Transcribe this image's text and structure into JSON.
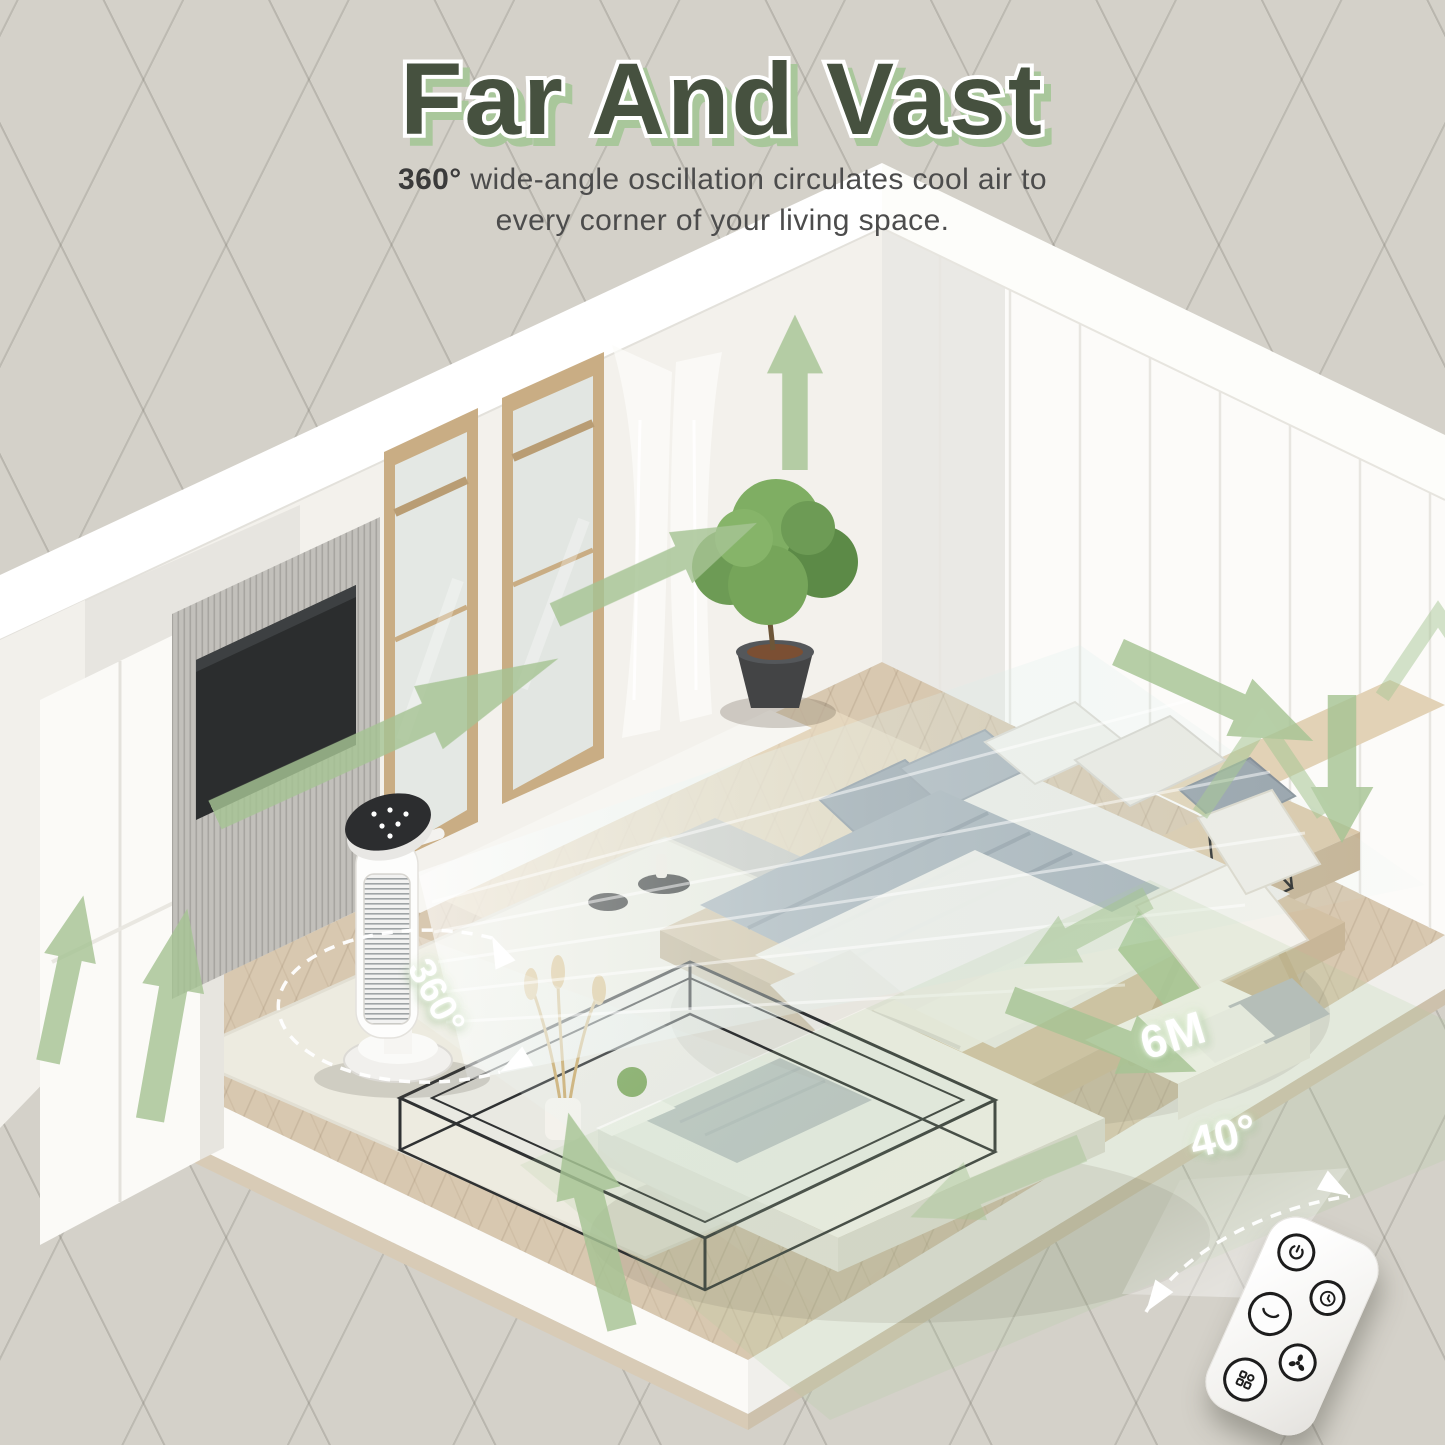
{
  "header": {
    "title": "Far And Vast",
    "subtitle_highlight": "360°",
    "subtitle_line1": " wide-angle oscillation circulates cool air to",
    "subtitle_line2": "every corner of your living space."
  },
  "annotations": {
    "oscillation_angle": "360°",
    "coverage_distance": "6M",
    "remote_angle": "40°"
  },
  "remote": {
    "buttons": [
      {
        "name": "power",
        "icon": "power-icon"
      },
      {
        "name": "timer",
        "icon": "timer-icon"
      },
      {
        "name": "swing",
        "icon": "swing-icon"
      },
      {
        "name": "fan-speed",
        "icon": "fan-icon"
      },
      {
        "name": "mode",
        "icon": "mode-grid-icon"
      }
    ]
  },
  "colors": {
    "background": "#d4d1c9",
    "accent_green": "#a6c494",
    "title_green": "#46513f",
    "title_shadow_green": "#a9c79b",
    "airflow_tint": "#cde6e0"
  }
}
